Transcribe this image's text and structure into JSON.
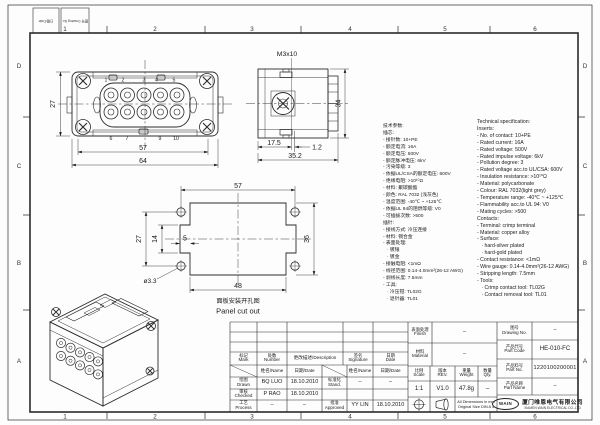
{
  "sheet": {
    "zones_h": [
      "1",
      "2",
      "3",
      "4",
      "5",
      "6"
    ],
    "zones_v": [
      "D",
      "C",
      "B",
      "A"
    ],
    "corner": {
      "box1": "日期/Date",
      "box2": "图号 Drawing No."
    }
  },
  "views": {
    "front": {
      "dim_height": "27",
      "dim_inner": "57",
      "dim_outer": "64",
      "pins_top": [
        "1",
        "2",
        "3",
        "4",
        "5"
      ],
      "pins_bottom": [
        "6",
        "7",
        "9",
        "10"
      ]
    },
    "side": {
      "thread": "M3x10",
      "dim_height": "34",
      "dim_a": "17.5",
      "dim_b": "1.2",
      "dim_total": "35.2"
    },
    "cutout": {
      "dim_top": "57",
      "dim_bottom": "48",
      "dim_left": "27",
      "dim_mid": "14",
      "dim_notch": "5",
      "dim_right": "36",
      "hole": "ø3.3",
      "caption_zh": "面板安装开孔图",
      "caption_en": "Panel cut out"
    }
  },
  "spec": {
    "zh": [
      "技术参数:",
      "插芯:",
      "- 接针数: 10+PE",
      "- 额定电流: 16A",
      "- 额定电压: 500V",
      "- 额定脉冲电压: 6kV",
      "- 污染等级: 3",
      "- 依据UL/CSA的额定电压: 600V",
      "- 绝缘电阻: >10¹⁰Ω",
      "- 材料: 聚碳酸酯",
      "- 颜色: RAL 7032 (浅灰色)",
      "- 温度范围: -40℃ ~ +125℃",
      "- 依据UL 94的阻燃等级: V0",
      "- 可插拔次数: >500",
      "插针:",
      "- 接线方式: 冷压连接",
      "- 材料: 铜合金",
      "- 表面处理:",
      "   · 镀银",
      "   · 镀金",
      "- 接触电阻: <1mΩ",
      "- 线径范围: 0.14-4.0mm²(26-12 AWG)",
      "- 剥线长度: 7.5mm",
      "- 工具:",
      "   · 冷压钳: TL02G",
      "   · 退针器: TL01"
    ],
    "en": [
      "Technical specification:",
      "Inserts:",
      "- No. of contact: 10+PE",
      "- Rated current: 16A",
      "- Rated voltage: 500V",
      "- Rated impulse voltage: 6kV",
      "- Pollution degree: 3",
      "- Rated voltage acc.to UL/CSA: 600V",
      "- Insulation resistance: >10¹⁰Ω",
      "- Material: polycarbonate",
      "- Colour: RAL 7032(light grey)",
      "- Temperature range: -40℃ ~ +125℃",
      "- Flammability acc.to UL 94: V0",
      "- Mating cycles: >500",
      "Contacts:",
      "- Terminal: crimp terminal",
      "- Material: copper alloy",
      "- Surface:",
      "   · hard-silver plated",
      "   · hard-gold plated",
      "- Contact resistance: <1mΩ",
      "- Wire gauge: 0.14-4.0mm²(26-12 AWG)",
      "- Stripping length: 7.5mm",
      "- Tools:",
      "   · Crimp contact tool: TL02G",
      "   · Contact removal tool: TL01"
    ]
  },
  "tb": {
    "mark_zh": "标记",
    "mark_en": "Mark",
    "number_zh": "处数",
    "number_en": "Number",
    "desc": "更改描述/Description",
    "sig_zh": "签名",
    "sig_en": "Signature",
    "date_zh": "日期",
    "date_en": "Date",
    "name_date": "姓名/Name",
    "date_date": "日期/Date",
    "drawn_zh": "绘图",
    "drawn_en": "Drawn",
    "drawn_name": "BQ LUO",
    "drawn_date": "18.10.2010",
    "checked_zh": "审核",
    "checked_en": "Checked",
    "checked_name": "P RAO",
    "checked_date": "18.10.2010",
    "process_zh": "工艺",
    "process_en": "Process",
    "process_name": "–",
    "process_date": "–",
    "stand_zh": "标准化",
    "stand_en": "Stand.",
    "stand_name": "–",
    "stand_date": "–",
    "appr_zh": "批准",
    "appr_en": "Approved",
    "appr_name": "YY LIN",
    "appr_date": "18.10.2010",
    "finish_zh": "表面处理",
    "finish_en": "Finish",
    "finish_val": "–",
    "material_zh": "材料",
    "material_en": "Material",
    "material_val": "–",
    "scale_zh": "比例",
    "scale_en": "Scale",
    "scale_val": "1:1",
    "rev_zh": "版本",
    "rev_en": "REV.",
    "rev_val": "V1.0",
    "weight_zh": "重量",
    "weight_en": "Weight",
    "weight_val": "47.8g",
    "qty_zh": "数量",
    "qty_en": "Qty.",
    "qty_val": "–",
    "dwgno_zh": "图号",
    "dwgno_en": "Drawing No.",
    "dwgno_val": "–",
    "pcode_zh": "产品代号",
    "pcode_en": "Part Code",
    "pcode_val": "HE-010-FC",
    "pno_zh": "产品料号",
    "pno_en": "Part No.",
    "pno_val": "1220100200001",
    "pname_zh": "产品名称",
    "pname_en": "Part Name",
    "pname_val": "–",
    "note1": "All Dimensions in mm",
    "note2": "Original Size DIN A 4",
    "logo": "WAIN",
    "company_zh": "厦门唯恩电气有限公司",
    "company_en": "XIAMEN WAIN ELECTRICAL CO.,LTD"
  }
}
